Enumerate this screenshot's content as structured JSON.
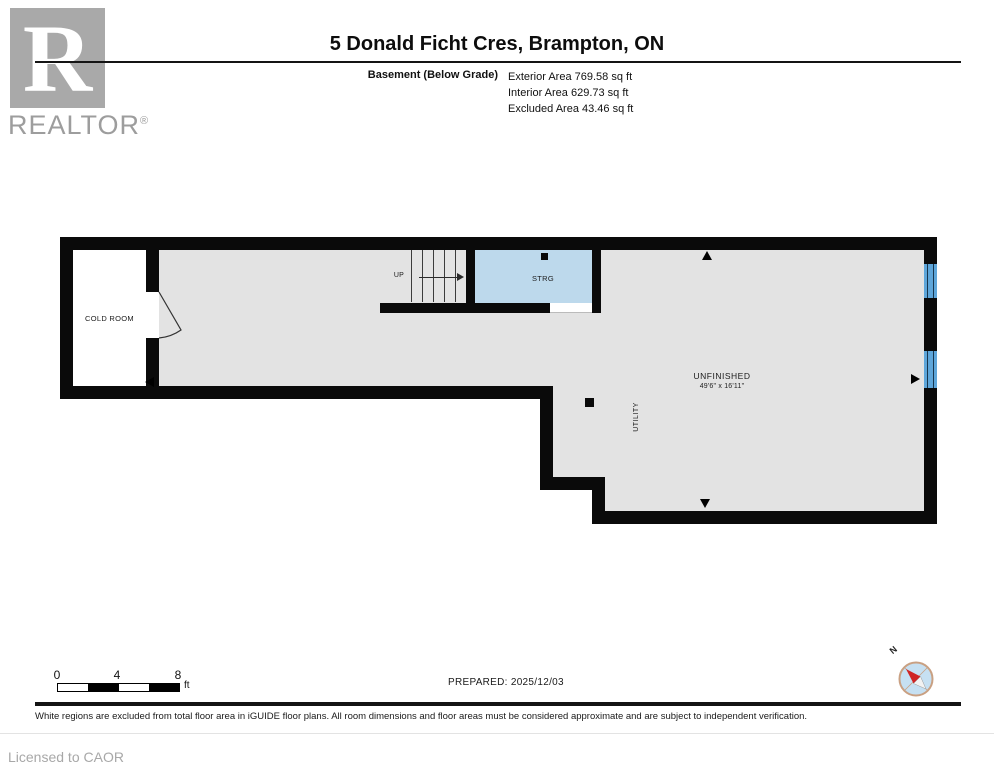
{
  "header": {
    "brand": {
      "letter": "R",
      "name": "REALTOR",
      "reg": "®"
    },
    "title": "5 Donald Ficht Cres, Brampton, ON",
    "floor_label": "Basement (Below Grade)",
    "area_lines": [
      "Exterior Area 769.58 sq ft",
      "Interior Area 629.73 sq ft",
      "Excluded Area 43.46 sq ft"
    ]
  },
  "plan": {
    "rooms": {
      "cold_room": "COLD ROOM",
      "stairs_up": "UP",
      "storage": "STRG",
      "unfinished": "UNFINISHED",
      "unfinished_dims": "49'6\" x 16'11\"",
      "utility": "UTILITY"
    }
  },
  "scale_bar": {
    "ticks": [
      "0",
      "4",
      "8"
    ],
    "unit": "ft"
  },
  "prepared_label": "PREPARED: 2025/12/03",
  "compass": {
    "north": "N"
  },
  "footer": {
    "disclaimer": "White regions are excluded from total floor area in iGUIDE floor plans. All room dimensions and floor areas must be considered approximate and are subject to independent verification.",
    "license": "Licensed to CAOR"
  },
  "colors": {
    "wall": "#0a0a0a",
    "floor_gray": "#e3e3e3",
    "storage_blue": "#bdd9ec",
    "window_blue": "#5ea6da",
    "brand_gray": "#a9a9a9"
  }
}
